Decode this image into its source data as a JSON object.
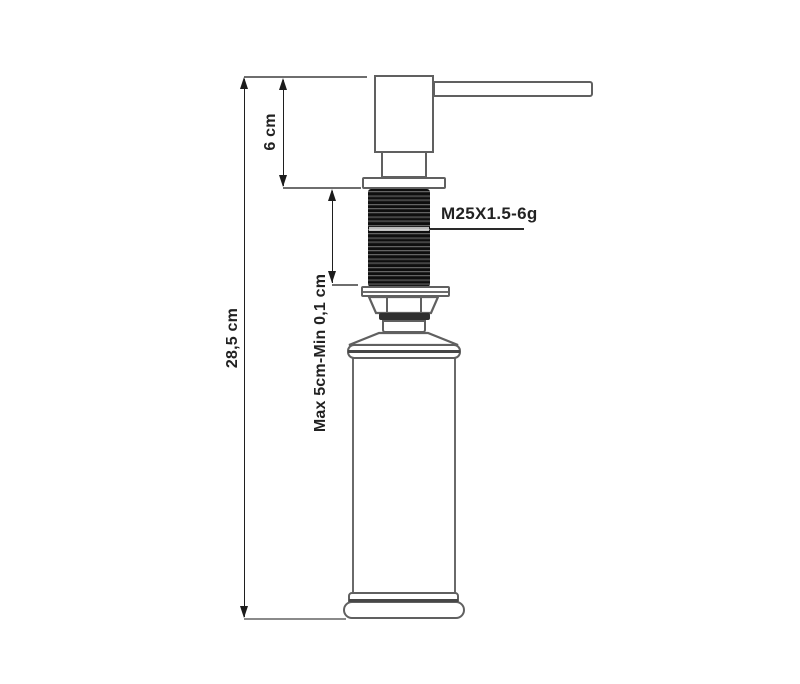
{
  "drawing": {
    "title": "soap dispenser technical drawing",
    "labels": {
      "total_height": "28,5 cm",
      "head_height": "6 cm",
      "mount_range": "Max 5cm-Min 0,1 cm",
      "thread_spec": "M25X1.5-6g"
    },
    "colors": {
      "background": "#ffffff",
      "outline": "#606060",
      "dimension_line": "#1c1c1c",
      "extension_line": "#8a8a8a",
      "thread_dark": "#0e0e0e",
      "text": "#222222"
    }
  }
}
